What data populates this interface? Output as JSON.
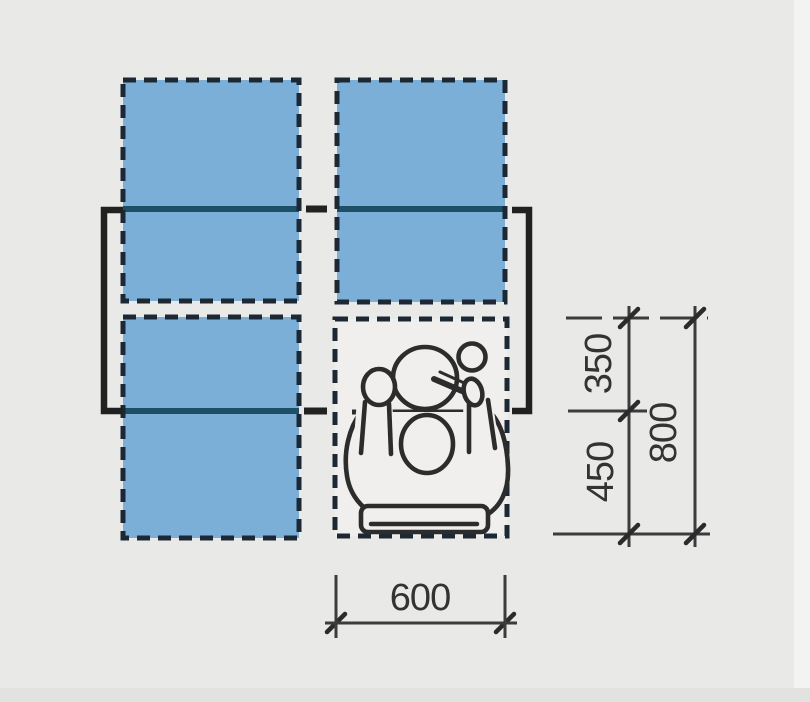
{
  "figure": {
    "kind": "plan-view dining table seating clearance diagram",
    "seat_zones_total": 4,
    "seat_zones_highlighted": 3,
    "seat_zones_occupied": 1
  },
  "colors": {
    "background": "#e9e9e7",
    "zone_fill": "#7cafd8",
    "table_edge": "#1d4f66",
    "ink": "#2c2c2c",
    "dash_border": "#1c2834",
    "zone_canvas": "#f0efed",
    "dim_line": "#3c3c3c",
    "dim_text": "#333333"
  },
  "annotations": {
    "dim_setting_depth": "350",
    "dim_chair_depth": "450",
    "dim_total_depth": "800",
    "dim_seat_width": "600"
  }
}
